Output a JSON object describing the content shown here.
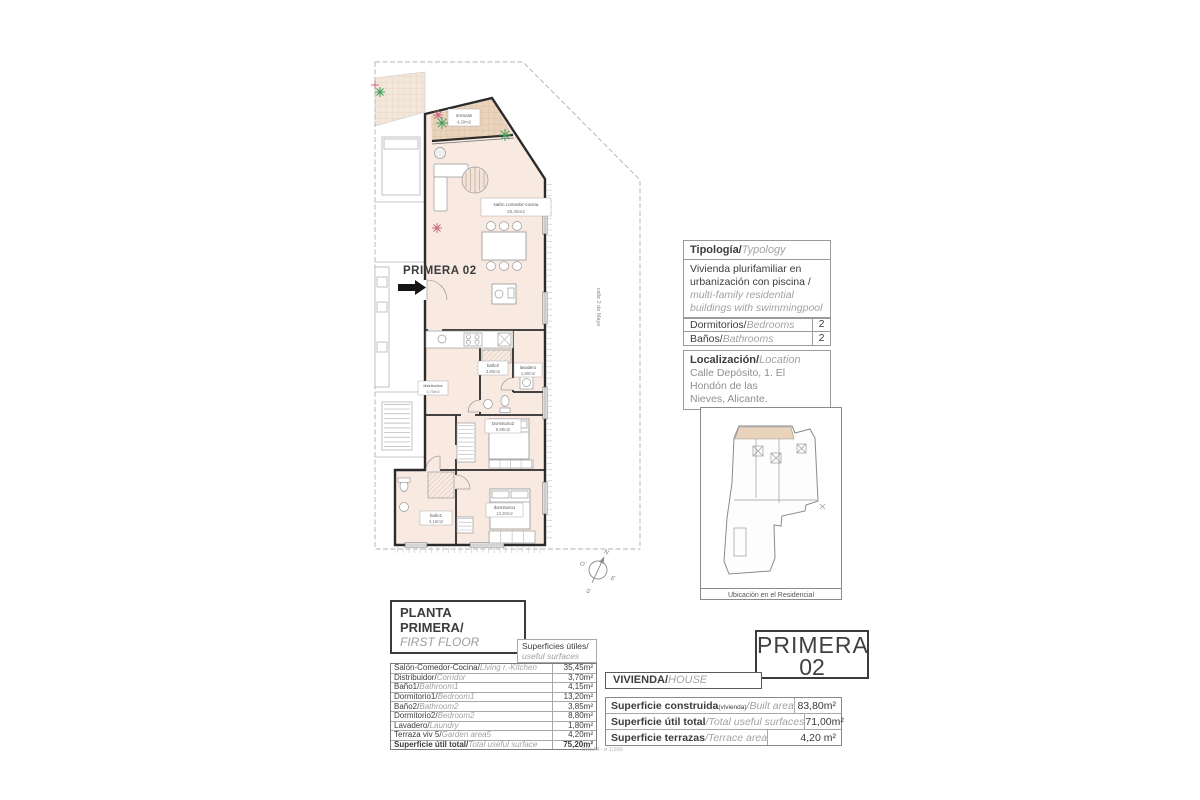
{
  "plan": {
    "unit_label": "PRIMERA 02",
    "street_label": "calle 2 de Mayo",
    "labels": [
      {
        "name": "terraza5",
        "area": "4,20m2"
      },
      {
        "name": "salón comedor-cocina",
        "area": "35,45m2"
      },
      {
        "name": "distribuidor",
        "area": "3,70m2"
      },
      {
        "name": "baño2",
        "area": "3,85m2"
      },
      {
        "name": "lavadero",
        "area": "1,80m2"
      },
      {
        "name": "Dormitorio2",
        "area": "8,80m2"
      },
      {
        "name": "dormitorio1",
        "area": "13,20m2"
      },
      {
        "name": "baño1",
        "area": "4,15m2"
      }
    ],
    "compass": {
      "n": "N",
      "s": "S",
      "e": "E",
      "w": "O"
    }
  },
  "typology": {
    "header_es": "Tipología/",
    "header_en": "Typology",
    "body_es": "Vivienda plurifamiliar en urbanización con piscina /",
    "body_en": "multi-family residential buildings with swimmingpool"
  },
  "rooms_table": {
    "rows": [
      {
        "es": "Dormitorios/",
        "en": "Bedrooms",
        "value": "2"
      },
      {
        "es": "Baños/",
        "en": "Bathrooms",
        "value": "2"
      }
    ]
  },
  "location": {
    "header_es": "Localización/",
    "header_en": "Location",
    "address_line1": "Calle Depósito, 1. El Hondón de las",
    "address_line2": "Nieves, Alicante."
  },
  "siteplan": {
    "caption": "Ubicación en el Residencial"
  },
  "floor_title": {
    "es": "PLANTA PRIMERA/",
    "en": "FIRST FLOOR"
  },
  "surfaces": {
    "header_es": "Superficies útiles/",
    "header_en": "useful surfaces",
    "rows": [
      {
        "es": "Salón-Comedor-Cocina/",
        "en": "Living r.-Kitchen",
        "value": "35,45m²"
      },
      {
        "es": "Distribuidor/",
        "en": "Corridor",
        "value": "3,70m²"
      },
      {
        "es": "Baño1/",
        "en": "Bathroom1",
        "value": "4,15m²"
      },
      {
        "es": "Dormitorio1/",
        "en": "Bedroom1",
        "value": "13,20m²"
      },
      {
        "es": "Baño2/",
        "en": "Bathroom2",
        "value": "3,85m²"
      },
      {
        "es": "Dormitorio2/",
        "en": "Bedroom2",
        "value": "8,80m²"
      },
      {
        "es": "Lavadero/",
        "en": "Laundry",
        "value": "1,80m²"
      },
      {
        "es": "Terraza viv 5/",
        "en": "Garden area5",
        "value": "4,20m²"
      },
      {
        "es": "Superficie útil total/",
        "en": "Total useful surface",
        "value": "75,20m²"
      }
    ]
  },
  "unit_card": {
    "name": "PRIMERA",
    "number": "02",
    "vivienda_es": "VIVIENDA/",
    "vivienda_en": "HOUSE",
    "rows": [
      {
        "es": "Superficie construida",
        "small": "(vivienda)",
        "en": "/Built area",
        "value": "83,80m²"
      },
      {
        "es": "Superficie útil total",
        "small": "",
        "en": "/Total useful surfaces",
        "value": "71,00m²"
      },
      {
        "es": "Superficie terrazas",
        "small": "",
        "en": "/Terrace area",
        "value": "4,20 m²"
      }
    ]
  },
  "footnote": "DIN A4 - e:1/100"
}
